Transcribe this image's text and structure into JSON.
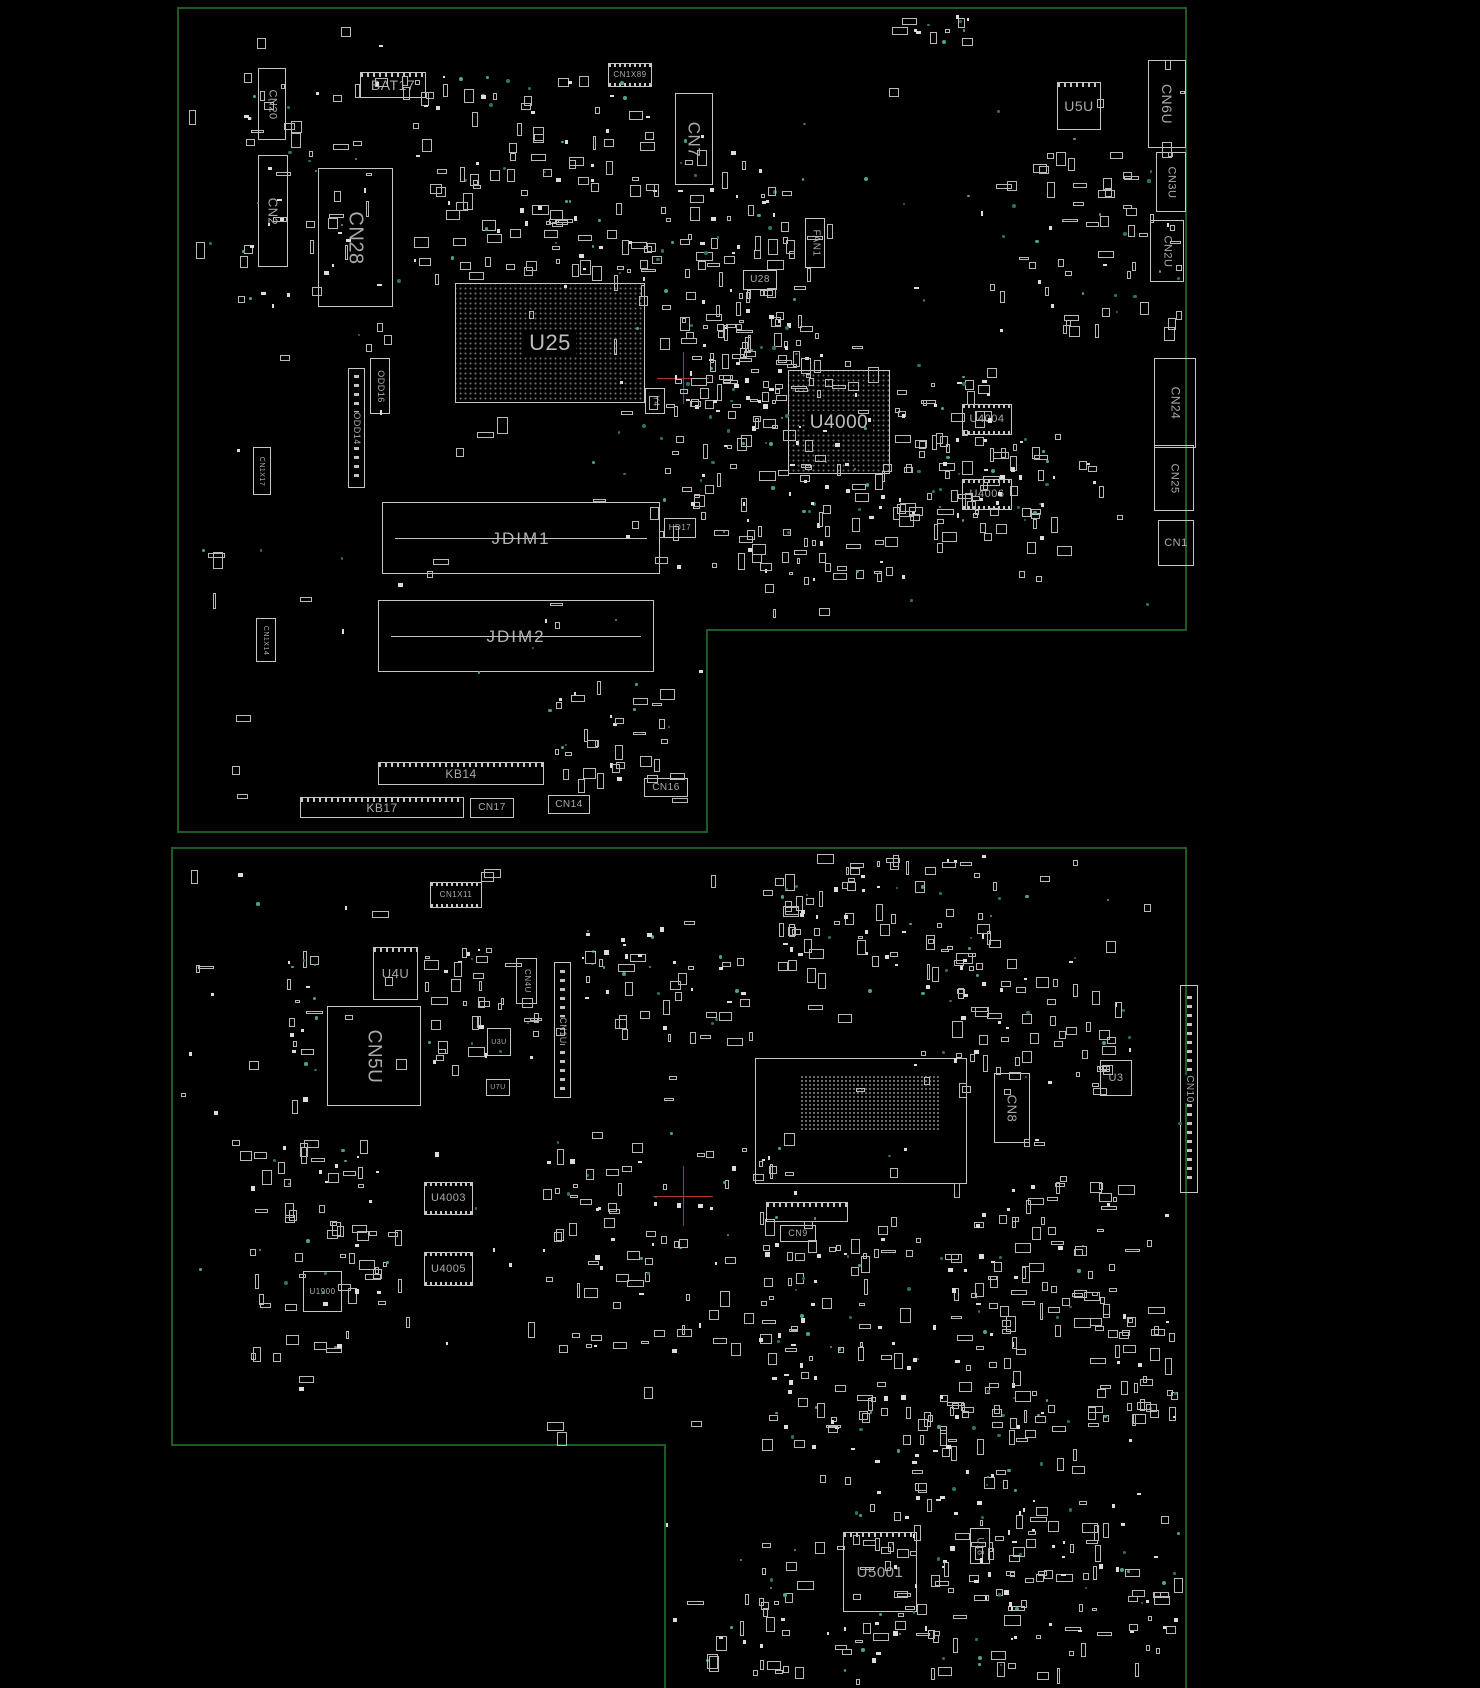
{
  "colors": {
    "background": "#000000",
    "board_outline": "#1c5c24",
    "component_outline": "#c6c6c6",
    "label": "#a8aca8",
    "marker_red": "#b13434",
    "dot_green_dim": "#2c7365",
    "dot_green_bright": "#4da389",
    "pad_fill": "#dcdcdc"
  },
  "boards": [
    {
      "name": "top-board",
      "outline": "178,8 1186,8 1186,630 707,630 707,832 178,832",
      "outline_closed": true,
      "components": [
        {
          "id": "CN20",
          "label": "CN20",
          "x": 258,
          "y": 68,
          "w": 28,
          "h": 72,
          "type": "box",
          "o": "v",
          "fs": 11
        },
        {
          "id": "CN2",
          "label": "CN2",
          "x": 258,
          "y": 155,
          "w": 30,
          "h": 112,
          "type": "box",
          "o": "v",
          "fs": 13
        },
        {
          "id": "CN28",
          "label": "CN28",
          "x": 318,
          "y": 168,
          "w": 75,
          "h": 139,
          "type": "box",
          "o": "v",
          "fs": 20
        },
        {
          "id": "BAT17",
          "label": "BAT17",
          "x": 360,
          "y": 72,
          "w": 66,
          "h": 26,
          "type": "teeth",
          "o": "h",
          "fs": 14
        },
        {
          "id": "CN1X89",
          "label": "CN1X89",
          "x": 608,
          "y": 63,
          "w": 44,
          "h": 24,
          "type": "chip",
          "o": "h",
          "fs": 8
        },
        {
          "id": "CN7",
          "label": "CN7",
          "x": 675,
          "y": 93,
          "w": 38,
          "h": 92,
          "type": "box",
          "o": "v",
          "fs": 17
        },
        {
          "id": "FAN1",
          "label": "FAN1",
          "x": 805,
          "y": 218,
          "w": 20,
          "h": 50,
          "type": "box",
          "o": "v",
          "fs": 10
        },
        {
          "id": "U28",
          "label": "U28",
          "x": 743,
          "y": 270,
          "w": 34,
          "h": 20,
          "type": "box",
          "o": "h",
          "fs": 10
        },
        {
          "id": "U25",
          "label": "U25",
          "x": 455,
          "y": 283,
          "w": 190,
          "h": 120,
          "type": "bga",
          "o": "h",
          "fs": 22
        },
        {
          "id": "ODD16",
          "label": "ODD16",
          "x": 370,
          "y": 358,
          "w": 20,
          "h": 56,
          "type": "box",
          "o": "v",
          "fs": 9
        },
        {
          "id": "ODD14",
          "label": "ODD14",
          "x": 348,
          "y": 368,
          "w": 17,
          "h": 120,
          "type": "connv",
          "o": "v",
          "fs": 9
        },
        {
          "id": "CN1X17",
          "label": "CN1X17",
          "x": 253,
          "y": 447,
          "w": 18,
          "h": 48,
          "type": "box",
          "o": "v",
          "fs": 7
        },
        {
          "id": "CN1X14",
          "label": "CN1X14",
          "x": 256,
          "y": 618,
          "w": 20,
          "h": 44,
          "type": "box",
          "o": "v",
          "fs": 7
        },
        {
          "id": "U4000",
          "label": "U4000",
          "x": 788,
          "y": 370,
          "w": 102,
          "h": 104,
          "type": "bga",
          "o": "h",
          "fs": 19
        },
        {
          "id": "Y4",
          "label": "Y4",
          "x": 645,
          "y": 388,
          "w": 20,
          "h": 26,
          "type": "box",
          "o": "v",
          "fs": 8
        },
        {
          "id": "U4004",
          "label": "U4004",
          "x": 962,
          "y": 404,
          "w": 50,
          "h": 31,
          "type": "chip",
          "o": "h",
          "fs": 11
        },
        {
          "id": "U4006",
          "label": "U4006",
          "x": 962,
          "y": 479,
          "w": 50,
          "h": 31,
          "type": "chip",
          "o": "h",
          "fs": 11
        },
        {
          "id": "U5U",
          "label": "U5U",
          "x": 1057,
          "y": 82,
          "w": 44,
          "h": 48,
          "type": "teeth",
          "o": "h",
          "fs": 14
        },
        {
          "id": "CN6U",
          "label": "CN6U",
          "x": 1148,
          "y": 60,
          "w": 38,
          "h": 88,
          "type": "box",
          "o": "v",
          "fs": 14
        },
        {
          "id": "CN3U",
          "label": "CN3U",
          "x": 1156,
          "y": 152,
          "w": 30,
          "h": 60,
          "type": "box",
          "o": "v",
          "fs": 11
        },
        {
          "id": "CN2U",
          "label": "CN2U",
          "x": 1150,
          "y": 220,
          "w": 34,
          "h": 62,
          "type": "box",
          "o": "v",
          "fs": 11
        },
        {
          "id": "CN24",
          "label": "CN24",
          "x": 1154,
          "y": 358,
          "w": 42,
          "h": 90,
          "type": "box",
          "o": "v",
          "fs": 12
        },
        {
          "id": "CN25",
          "label": "CN25",
          "x": 1154,
          "y": 445,
          "w": 40,
          "h": 66,
          "type": "box",
          "o": "v",
          "fs": 11
        },
        {
          "id": "CN1",
          "label": "CN1",
          "x": 1158,
          "y": 520,
          "w": 36,
          "h": 46,
          "type": "box",
          "o": "h",
          "fs": 11
        },
        {
          "id": "JDIM1",
          "label": "JDIM1",
          "x": 382,
          "y": 502,
          "w": 278,
          "h": 72,
          "type": "dimm",
          "o": "h",
          "fs": 17
        },
        {
          "id": "JDIM2",
          "label": "JDIM2",
          "x": 378,
          "y": 600,
          "w": 276,
          "h": 72,
          "type": "dimm",
          "o": "h",
          "fs": 17
        },
        {
          "id": "HD17",
          "label": "HD17",
          "x": 664,
          "y": 518,
          "w": 32,
          "h": 20,
          "type": "box",
          "o": "h",
          "fs": 8
        },
        {
          "id": "KB14",
          "label": "KB14",
          "x": 378,
          "y": 762,
          "w": 166,
          "h": 23,
          "type": "teeth",
          "o": "h",
          "fs": 12
        },
        {
          "id": "KB17",
          "label": "KB17",
          "x": 300,
          "y": 797,
          "w": 164,
          "h": 21,
          "type": "teeth",
          "o": "h",
          "fs": 12
        },
        {
          "id": "CN17",
          "label": "CN17",
          "x": 470,
          "y": 798,
          "w": 44,
          "h": 20,
          "type": "box",
          "o": "h",
          "fs": 10
        },
        {
          "id": "CN14",
          "label": "CN14",
          "x": 548,
          "y": 795,
          "w": 42,
          "h": 19,
          "type": "box",
          "o": "h",
          "fs": 10
        },
        {
          "id": "CN16",
          "label": "CN16",
          "x": 644,
          "y": 778,
          "w": 44,
          "h": 19,
          "type": "box",
          "o": "h",
          "fs": 10
        }
      ],
      "markers": [
        {
          "x": 683,
          "y": 378,
          "r": 26
        }
      ],
      "scatter": {
        "seed": 7,
        "bbox": {
          "x": 185,
          "y": 15,
          "w": 995,
          "h": 810
        },
        "uniform": 130,
        "clusters": [
          {
            "x": 400,
            "y": 75,
            "w": 250,
            "h": 200,
            "n": 125
          },
          {
            "x": 630,
            "y": 150,
            "w": 180,
            "h": 190,
            "n": 85
          },
          {
            "x": 660,
            "y": 285,
            "w": 160,
            "h": 160,
            "n": 75
          },
          {
            "x": 700,
            "y": 345,
            "w": 170,
            "h": 130,
            "n": 60
          },
          {
            "x": 890,
            "y": 370,
            "w": 105,
            "h": 150,
            "n": 50
          },
          {
            "x": 935,
            "y": 430,
            "w": 165,
            "h": 120,
            "n": 55
          },
          {
            "x": 650,
            "y": 460,
            "w": 260,
            "h": 120,
            "n": 85
          },
          {
            "x": 240,
            "y": 55,
            "w": 140,
            "h": 250,
            "n": 55
          },
          {
            "x": 1000,
            "y": 150,
            "w": 190,
            "h": 180,
            "n": 65
          },
          {
            "x": 555,
            "y": 680,
            "w": 130,
            "h": 70,
            "n": 22
          },
          {
            "x": 890,
            "y": 12,
            "w": 80,
            "h": 28,
            "n": 14
          },
          {
            "x": 550,
            "y": 745,
            "w": 110,
            "h": 35,
            "n": 14
          }
        ]
      }
    },
    {
      "name": "bottom-board",
      "outline": "665,1688 665,1445 172,1445 172,848 1186,848 1186,1688",
      "outline_closed": false,
      "components": [
        {
          "id": "CN1X11",
          "label": "CN1X11",
          "x": 430,
          "y": 882,
          "w": 52,
          "h": 26,
          "type": "chip",
          "o": "h",
          "fs": 8
        },
        {
          "id": "U4U",
          "label": "U4U",
          "x": 373,
          "y": 947,
          "w": 45,
          "h": 53,
          "type": "teeth",
          "o": "h",
          "fs": 13
        },
        {
          "id": "CN5U",
          "label": "CN5U",
          "x": 327,
          "y": 1006,
          "w": 94,
          "h": 100,
          "type": "box",
          "o": "v",
          "fs": 19
        },
        {
          "id": "CN4U",
          "label": "CN4U",
          "x": 516,
          "y": 958,
          "w": 21,
          "h": 46,
          "type": "box",
          "o": "v",
          "fs": 8
        },
        {
          "id": "CN1U",
          "label": "CN1U",
          "x": 554,
          "y": 962,
          "w": 17,
          "h": 136,
          "type": "connv",
          "o": "v",
          "fs": 9
        },
        {
          "id": "U3U",
          "label": "U3U",
          "x": 487,
          "y": 1028,
          "w": 24,
          "h": 28,
          "type": "box",
          "o": "h",
          "fs": 7
        },
        {
          "id": "U7U",
          "label": "U7U",
          "x": 486,
          "y": 1079,
          "w": 24,
          "h": 17,
          "type": "box",
          "o": "h",
          "fs": 7
        },
        {
          "id": "MAIN-BGA",
          "label": "",
          "x": 755,
          "y": 1058,
          "w": 212,
          "h": 126,
          "type": "box",
          "o": "h",
          "fs": 0
        },
        {
          "id": "PAD-GRID",
          "label": "",
          "x": 800,
          "y": 1075,
          "w": 140,
          "h": 56,
          "type": "grid",
          "o": "h",
          "fs": 0
        },
        {
          "id": "U4003",
          "label": "U4003",
          "x": 424,
          "y": 1182,
          "w": 49,
          "h": 33,
          "type": "chip",
          "o": "h",
          "fs": 11
        },
        {
          "id": "U4005",
          "label": "U4005",
          "x": 424,
          "y": 1252,
          "w": 49,
          "h": 34,
          "type": "chip",
          "o": "h",
          "fs": 11
        },
        {
          "id": "U1900",
          "label": "U1900",
          "x": 303,
          "y": 1271,
          "w": 39,
          "h": 41,
          "type": "box",
          "o": "h",
          "fs": 8
        },
        {
          "id": "CN9-CONN",
          "label": "",
          "x": 766,
          "y": 1202,
          "w": 82,
          "h": 20,
          "type": "teeth",
          "o": "h",
          "fs": 0
        },
        {
          "id": "CN9",
          "label": "CN9",
          "x": 780,
          "y": 1225,
          "w": 36,
          "h": 17,
          "type": "box",
          "o": "h",
          "fs": 9
        },
        {
          "id": "CN8",
          "label": "CN8",
          "x": 994,
          "y": 1073,
          "w": 36,
          "h": 70,
          "type": "box",
          "o": "v",
          "fs": 13
        },
        {
          "id": "U3",
          "label": "U3",
          "x": 1100,
          "y": 1060,
          "w": 32,
          "h": 36,
          "type": "box",
          "o": "h",
          "fs": 11
        },
        {
          "id": "CN10",
          "label": "CN10",
          "x": 1180,
          "y": 985,
          "w": 18,
          "h": 208,
          "type": "connv",
          "o": "v",
          "fs": 10
        },
        {
          "id": "U5001",
          "label": "U5001",
          "x": 843,
          "y": 1532,
          "w": 74,
          "h": 80,
          "type": "teeth",
          "o": "h",
          "fs": 15
        },
        {
          "id": "U18",
          "label": "U18",
          "x": 970,
          "y": 1528,
          "w": 20,
          "h": 36,
          "type": "box",
          "o": "v",
          "fs": 9
        }
      ],
      "markers": [
        {
          "x": 683,
          "y": 1196,
          "r": 30
        }
      ],
      "scatter": {
        "seed": 13,
        "bbox": {
          "x": 180,
          "y": 856,
          "w": 1000,
          "h": 824
        },
        "uniform": 150,
        "clusters": [
          {
            "x": 760,
            "y": 840,
            "w": 240,
            "h": 130,
            "n": 90
          },
          {
            "x": 910,
            "y": 930,
            "w": 220,
            "h": 160,
            "n": 80
          },
          {
            "x": 580,
            "y": 920,
            "w": 180,
            "h": 120,
            "n": 50
          },
          {
            "x": 420,
            "y": 940,
            "w": 120,
            "h": 120,
            "n": 40
          },
          {
            "x": 285,
            "y": 950,
            "w": 30,
            "h": 160,
            "n": 22
          },
          {
            "x": 250,
            "y": 1140,
            "w": 140,
            "h": 220,
            "n": 70
          },
          {
            "x": 540,
            "y": 1130,
            "w": 260,
            "h": 220,
            "n": 100
          },
          {
            "x": 760,
            "y": 1230,
            "w": 260,
            "h": 220,
            "n": 110
          },
          {
            "x": 950,
            "y": 1180,
            "w": 180,
            "h": 160,
            "n": 60
          },
          {
            "x": 820,
            "y": 1380,
            "w": 280,
            "h": 200,
            "n": 110
          },
          {
            "x": 700,
            "y": 1540,
            "w": 320,
            "h": 130,
            "n": 90
          },
          {
            "x": 980,
            "y": 1500,
            "w": 200,
            "h": 170,
            "n": 65
          },
          {
            "x": 1080,
            "y": 1300,
            "w": 100,
            "h": 150,
            "n": 38
          }
        ]
      }
    }
  ]
}
